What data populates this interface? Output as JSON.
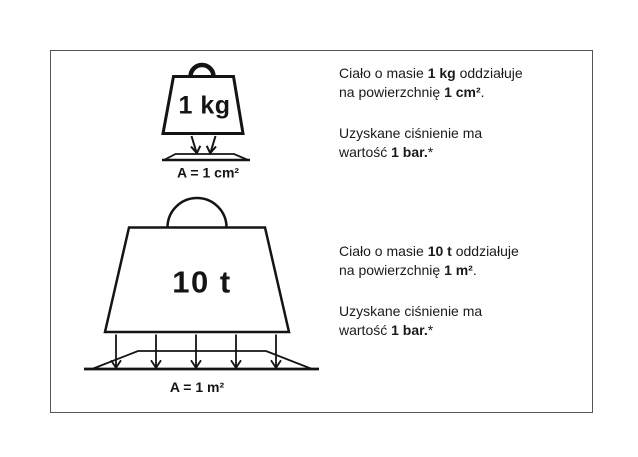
{
  "figure": {
    "small_weight": {
      "mass_label": "1 kg",
      "area_label": "A = 1 cm²"
    },
    "large_weight": {
      "mass_label": "10 t",
      "area_label": "A = 1 m²"
    }
  },
  "captions": {
    "block1": {
      "p1_l1_pre": "Ciało o masie ",
      "p1_l1_bold": "1 kg",
      "p1_l1_post": " oddziałuje",
      "p1_l2_pre": "na powierzchnię ",
      "p1_l2_bold": "1 cm²",
      "p1_l2_post": ".",
      "p2_l1": "Uzyskane ciśnienie ma",
      "p2_l2_pre": "wartość ",
      "p2_l2_bold": "1 bar.",
      "p2_l2_post": "*"
    },
    "block2": {
      "p1_l1_pre": "Ciało o masie ",
      "p1_l1_bold": "10 t",
      "p1_l1_post": " oddziałuje",
      "p1_l2_pre": "na powierzchnię ",
      "p1_l2_bold": "1 m²",
      "p1_l2_post": ".",
      "p2_l1": "Uzyskane ciśnienie ma",
      "p2_l2_pre": "wartość ",
      "p2_l2_bold": "1 bar.",
      "p2_l2_post": "*"
    }
  },
  "colors": {
    "ink": "#141414",
    "frame_border": "#555555",
    "background": "#ffffff"
  }
}
